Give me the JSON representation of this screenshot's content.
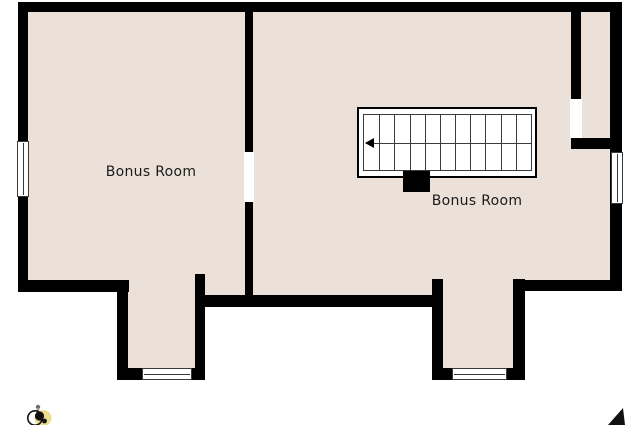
{
  "floorplan": {
    "background_color": "#FFFFFF",
    "floor_color": "#ECE1D9",
    "wall_color": "#000000",
    "line_color": "#3A3A3A",
    "text_color": "#1A1A1A",
    "rooms": [
      {
        "label": "Bonus Room"
      },
      {
        "label": "Bonus Room"
      }
    ],
    "stairs": {
      "treads": 11,
      "arrow_direction": "left"
    },
    "icons": [
      {
        "name": "logo-icon",
        "burst_color": "#EBDE8C",
        "body_color": "#111111",
        "accent_color": "#6E6E6E"
      },
      {
        "name": "north-arrow-icon",
        "color": "#111111"
      }
    ]
  }
}
